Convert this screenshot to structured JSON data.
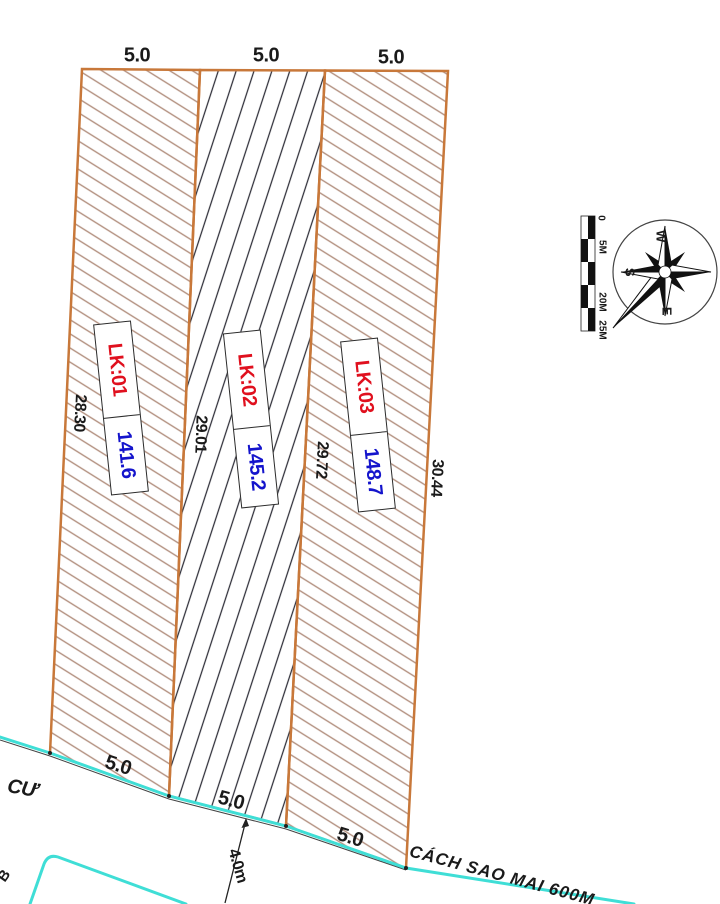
{
  "drawing": {
    "plots": [
      {
        "id": "LK:01",
        "area": "141.6",
        "top_dim": "5.0",
        "bottom_dim": "5.0",
        "left_edge_dim": "28.30"
      },
      {
        "id": "LK:02",
        "area": "145.2",
        "top_dim": "5.0",
        "bottom_dim": "5.0",
        "left_edge_dim": "29.01"
      },
      {
        "id": "LK:03",
        "area": "148.7",
        "top_dim": "5.0",
        "bottom_dim": "5.0",
        "left_edge_dim": "29.72",
        "right_edge_dim": "30.44"
      }
    ],
    "road": {
      "name": "CÁCH SAO MAI 600M",
      "width_dim": "4.0m",
      "adjacent_area_label": "CƯ",
      "edge_letter": "B"
    },
    "compass": {
      "west": "W",
      "south": "S",
      "east": "E"
    },
    "scale_bar": {
      "ticks": [
        "0",
        "5M",
        "20M",
        "25M"
      ]
    },
    "colors": {
      "boundary": "#c8783a",
      "hatch_outer": "#b2907f",
      "hatch_middle": "#2e2e38",
      "road_line": "#3fded6",
      "plot_id_text": "#e0101e",
      "area_text": "#1414cc"
    }
  }
}
